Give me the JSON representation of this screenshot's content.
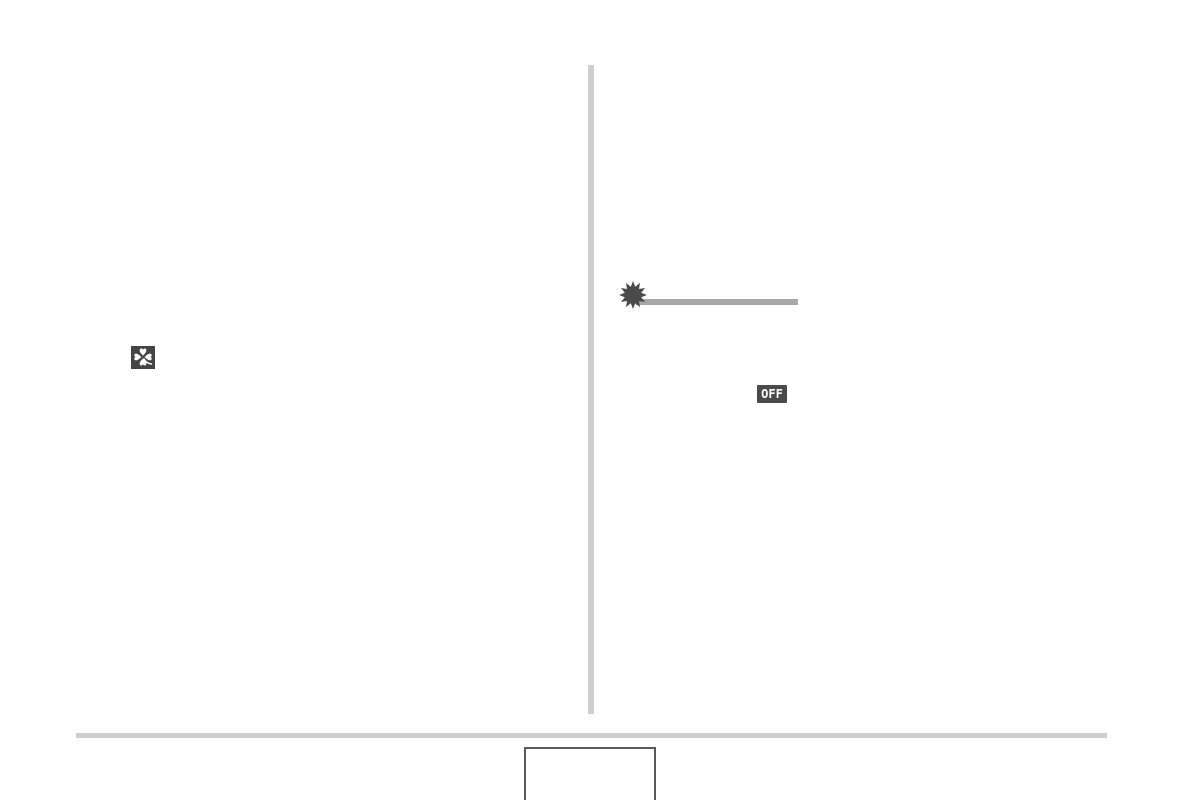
{
  "colors": {
    "page_background": "#ffffff",
    "column_divider": "#cecece",
    "footer_rule": "#cecece",
    "clover_icon_background": "#454545",
    "clover_icon_foreground": "#ffffff",
    "starburst_icon": "#4a4a4a",
    "callout_line": "#a8a8a8",
    "off_badge_background": "#4a4a4a",
    "off_badge_text": "#ffffff",
    "page_number_box_border": "#5a5a5a"
  },
  "icons": {
    "clover": "four-leaf-clover-icon",
    "starburst": "starburst-flash-icon"
  },
  "off_badge": {
    "label": "OFF"
  }
}
